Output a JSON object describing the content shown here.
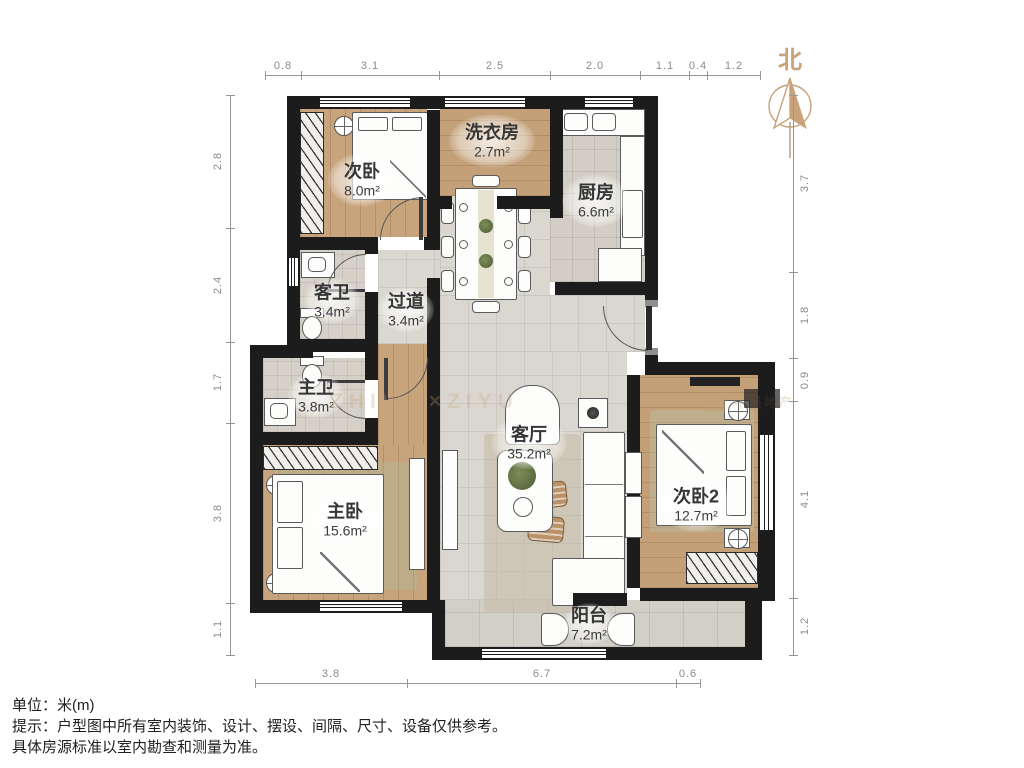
{
  "north": {
    "label": "北"
  },
  "rooms": [
    {
      "name": "次卧",
      "area": "8.0m²"
    },
    {
      "name": "洗衣房",
      "area": "2.7m²"
    },
    {
      "name": "厨房",
      "area": "6.6m²"
    },
    {
      "name": "客卫",
      "area": "3.4m²"
    },
    {
      "name": "过道",
      "area": "3.4m²"
    },
    {
      "name": "主卫",
      "area": "3.8m²"
    },
    {
      "name": "主卧",
      "area": "15.6m²"
    },
    {
      "name": "客厅",
      "area": "35.2m²"
    },
    {
      "name": "次卧2",
      "area": "12.7m²"
    },
    {
      "name": "阳台",
      "area": "7.2m²"
    }
  ],
  "dimensions": {
    "top": [
      "0.8",
      "3.1",
      "2.5",
      "2.0",
      "1.1",
      "0.4",
      "1.2"
    ],
    "left": [
      "2.8",
      "2.4",
      "1.7",
      "3.8",
      "1.1"
    ],
    "right": [
      "3.7",
      "1.8",
      "0.9",
      "4.1",
      "1.2"
    ],
    "bottom": [
      "3.8",
      "6.7",
      "0.6"
    ]
  },
  "footer": {
    "unit": "单位：米(m)",
    "tip1": "提示：户型图中所有室内装饰、设计、摆设、间隔、尺寸、设备仅供参考。",
    "tip2": "具体房源标准以室内勘查和测量为准。"
  },
  "watermark": {
    "text": "ZHIWU×ZIYU",
    "brand": "中星地产"
  },
  "colors": {
    "wall": "#1c1c1c",
    "wood": "#c8a47d",
    "tile": "#dad7d0",
    "accent": "#c9a279",
    "dim_text": "#8a8a8a",
    "label_text": "#363636"
  }
}
